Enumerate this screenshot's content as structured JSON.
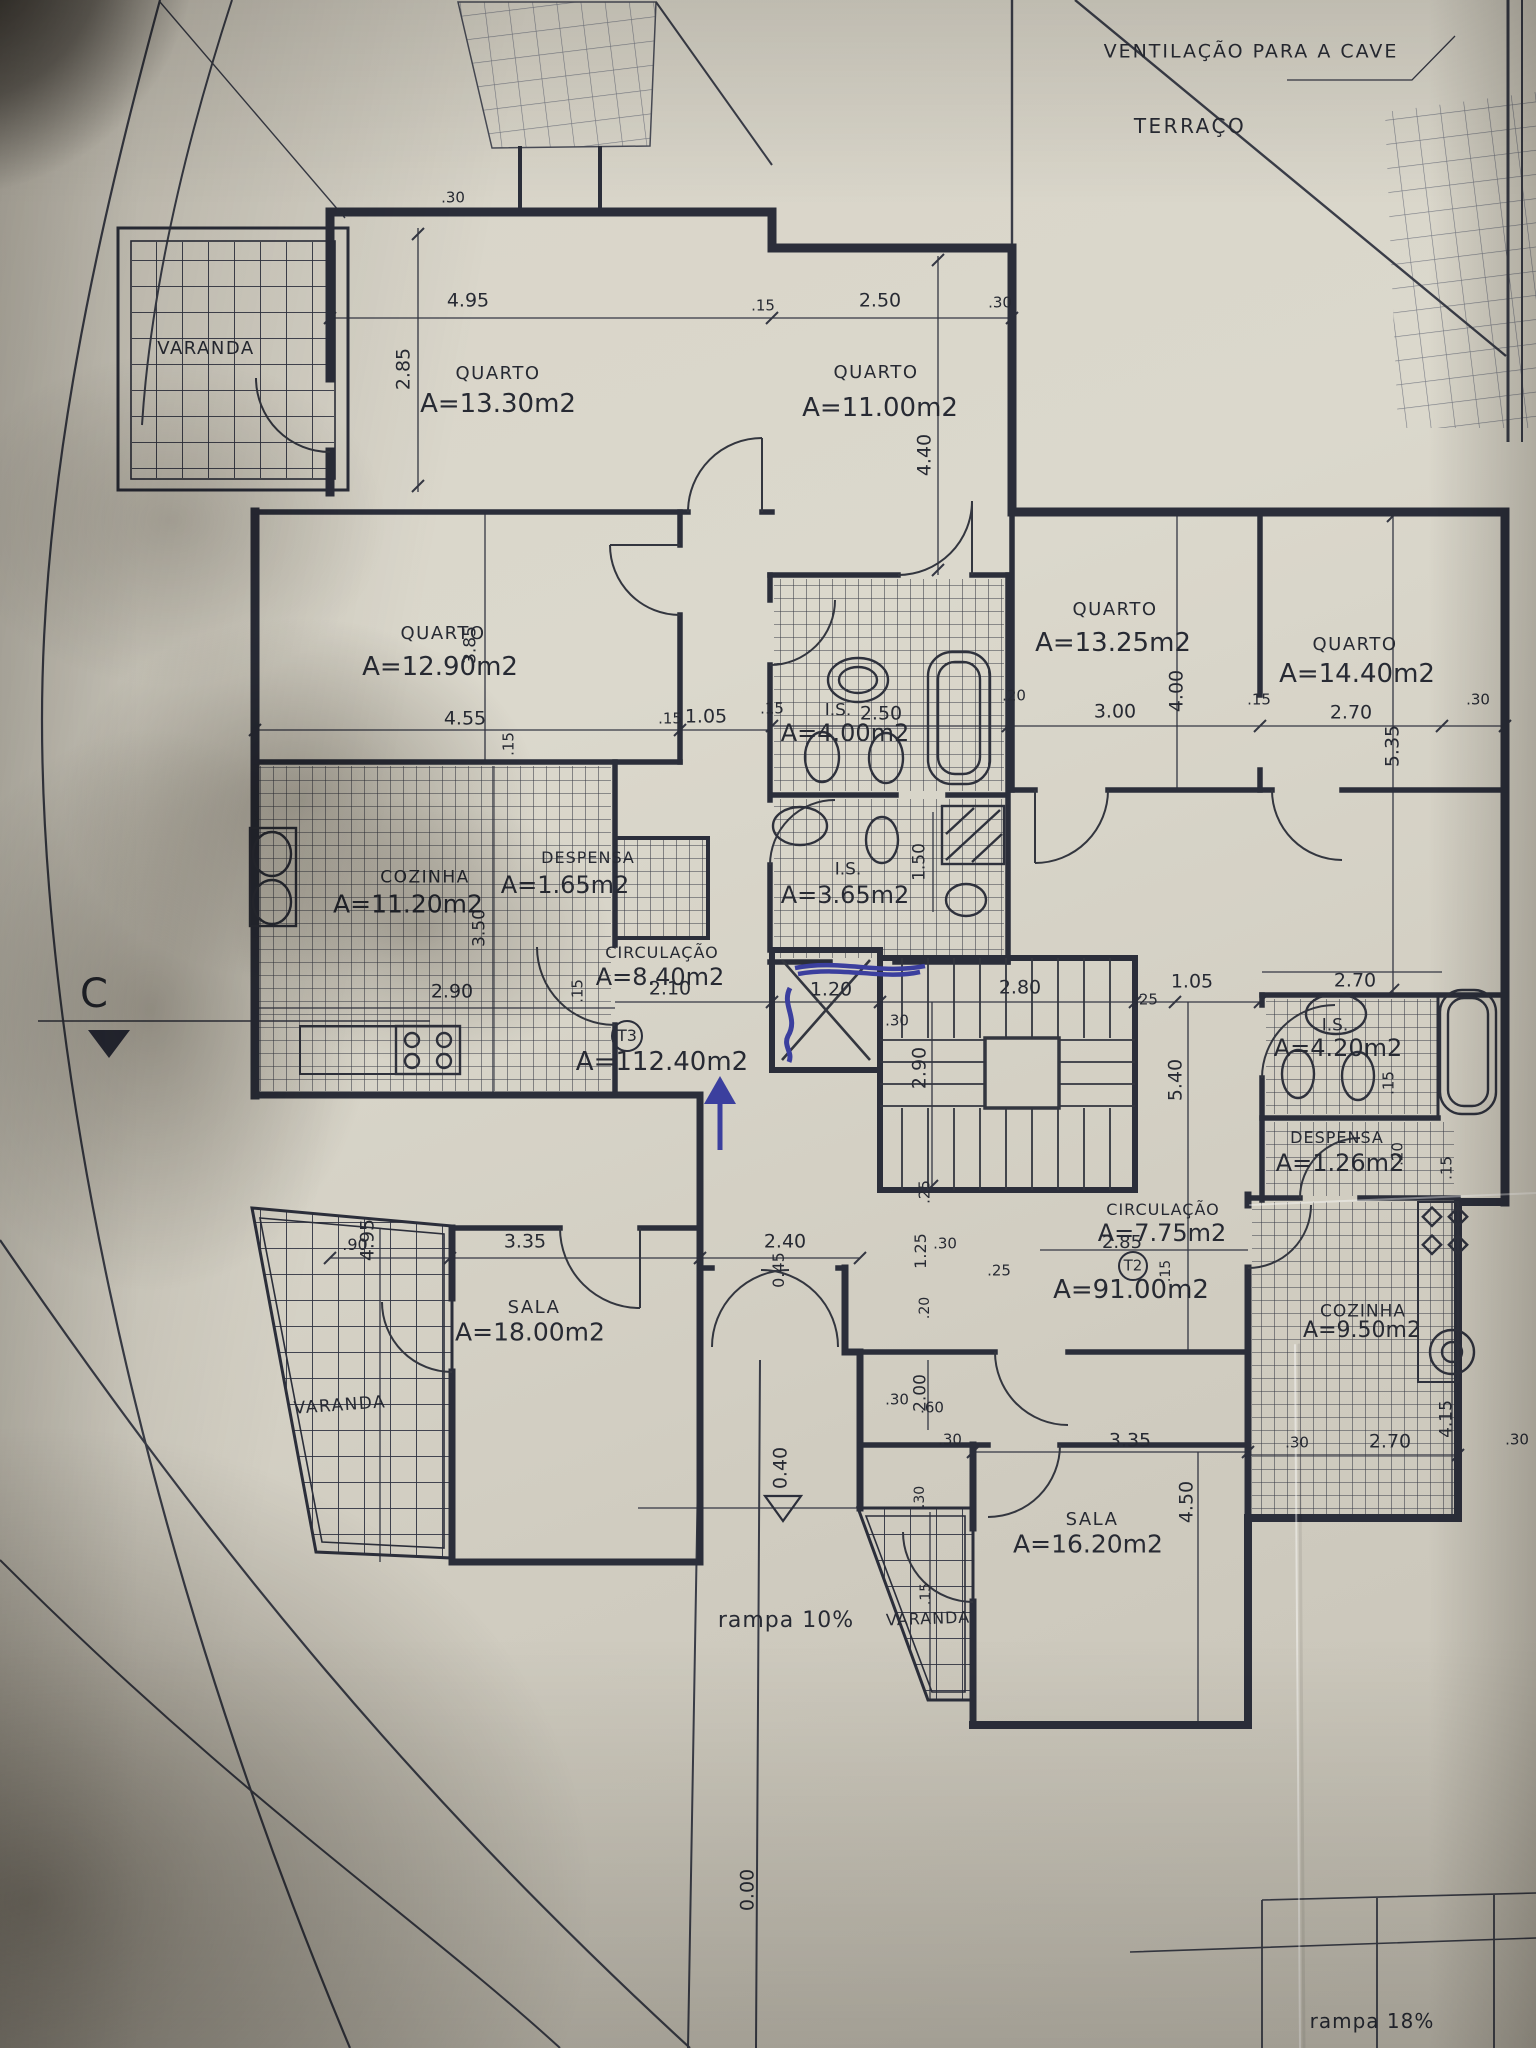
{
  "photo": {
    "paper_color": "#d4d0c4",
    "ink_color": "#2b2e3a",
    "pen_color": "#3b3f9e",
    "pen_annotations": [
      "up-arrow",
      "scribble-at-elevator",
      "scribble-horizontal"
    ]
  },
  "summary": {
    "notes": [
      "VENTILAÇÃO PARA A CAVE",
      "TERRAÇO",
      "rampa 10%",
      "rampa 18%"
    ],
    "section_marker": "C",
    "levels": [
      "0.40",
      "0.00"
    ],
    "apartments": [
      {
        "id": "T3",
        "total_area": "A=112.40m2",
        "rooms": [
          {
            "name": "QUARTO",
            "area": "A=13.30m2"
          },
          {
            "name": "QUARTO",
            "area": "A=11.00m2"
          },
          {
            "name": "QUARTO",
            "area": "A=12.90m2"
          },
          {
            "name": "I.S.",
            "area": "A=4.00m2"
          },
          {
            "name": "I.S.",
            "area": "A=3.65m2"
          },
          {
            "name": "COZINHA",
            "area": "A=11.20m2"
          },
          {
            "name": "DESPENSA",
            "area": "A=1.65m2"
          },
          {
            "name": "CIRCULAÇÃO",
            "area": "A=8.40m2"
          },
          {
            "name": "SALA",
            "area": "A=18.00m2"
          },
          {
            "name": "VARANDA",
            "area": ""
          },
          {
            "name": "VARANDA",
            "area": ""
          }
        ]
      },
      {
        "id": "T2",
        "total_area": "A=91.00m2",
        "rooms": [
          {
            "name": "QUARTO",
            "area": "A=13.25m2"
          },
          {
            "name": "QUARTO",
            "area": "A=14.40m2"
          },
          {
            "name": "I.S.",
            "area": "A=4.20m2"
          },
          {
            "name": "DESPENSA",
            "area": "A=1.26m2"
          },
          {
            "name": "CIRCULAÇÃO",
            "area": "A=7.75m2"
          },
          {
            "name": "COZINHA",
            "area": "A=9.50m2"
          },
          {
            "name": "SALA",
            "area": "A=16.20m2"
          },
          {
            "name": "VARANDA",
            "area": ""
          }
        ]
      }
    ]
  },
  "labels": [
    {
      "id": "ventilation-note",
      "text": "VENTILAÇÃO PARA A CAVE",
      "x": 1251,
      "y": 52,
      "fs": 19,
      "ls": 2
    },
    {
      "id": "terrace-label",
      "text": "TERRAÇO",
      "x": 1190,
      "y": 126,
      "fs": 20,
      "ls": 2.5
    },
    {
      "id": "section-c",
      "text": "C",
      "x": 94,
      "y": 994,
      "fs": 40
    },
    {
      "id": "varanda-top-left",
      "text": "VARANDA",
      "x": 206,
      "y": 349,
      "fs": 18,
      "ls": 1.5
    },
    {
      "id": "quarto1-name",
      "text": "QUARTO",
      "x": 498,
      "y": 374,
      "fs": 18,
      "ls": 1.5
    },
    {
      "id": "quarto1-area",
      "text": "A=13.30m2",
      "x": 498,
      "y": 404,
      "fs": 26
    },
    {
      "id": "quarto2-name",
      "text": "QUARTO",
      "x": 876,
      "y": 373,
      "fs": 18,
      "ls": 1.5
    },
    {
      "id": "quarto2-area",
      "text": "A=11.00m2",
      "x": 880,
      "y": 408,
      "fs": 26
    },
    {
      "id": "quarto3-name",
      "text": "QUARTO",
      "x": 443,
      "y": 634,
      "fs": 18,
      "ls": 1.5
    },
    {
      "id": "quarto3-area",
      "text": "A=12.90m2",
      "x": 440,
      "y": 667,
      "fs": 26
    },
    {
      "id": "is1-name",
      "text": "I.S.",
      "x": 838,
      "y": 711,
      "fs": 17
    },
    {
      "id": "is1-area",
      "text": "A=4.00m2",
      "x": 845,
      "y": 733,
      "fs": 24
    },
    {
      "id": "is2-name",
      "text": "I.S.",
      "x": 848,
      "y": 870,
      "fs": 17
    },
    {
      "id": "is2-area",
      "text": "A=3.65m2",
      "x": 845,
      "y": 895,
      "fs": 24
    },
    {
      "id": "cozinha1-name",
      "text": "COZINHA",
      "x": 425,
      "y": 878,
      "fs": 17,
      "ls": 1.5
    },
    {
      "id": "cozinha1-area",
      "text": "A=11.20m2",
      "x": 408,
      "y": 904,
      "fs": 25
    },
    {
      "id": "despensa1-name",
      "text": "DESPENSA",
      "x": 588,
      "y": 858,
      "fs": 16,
      "ls": 1
    },
    {
      "id": "despensa1-area",
      "text": "A=1.65m2",
      "x": 565,
      "y": 885,
      "fs": 24
    },
    {
      "id": "circulacao1-name",
      "text": "CIRCULAÇÃO",
      "x": 662,
      "y": 953,
      "fs": 16,
      "ls": 1
    },
    {
      "id": "circulacao1-area",
      "text": "A=8.40m2",
      "x": 660,
      "y": 977,
      "fs": 24
    },
    {
      "id": "t3-id",
      "text": "T3",
      "x": 627,
      "y": 1036,
      "fs": 16
    },
    {
      "id": "t3-area",
      "text": "A=112.40m2",
      "x": 662,
      "y": 1062,
      "fs": 26
    },
    {
      "id": "sala1-name",
      "text": "SALA",
      "x": 534,
      "y": 1308,
      "fs": 18,
      "ls": 1.5
    },
    {
      "id": "sala1-area",
      "text": "A=18.00m2",
      "x": 530,
      "y": 1332,
      "fs": 25
    },
    {
      "id": "varanda-left",
      "text": "VARANDA",
      "x": 340,
      "y": 1406,
      "fs": 17,
      "ls": 1.5,
      "rot": -4
    },
    {
      "id": "varanda-bottom",
      "text": "VARANDA",
      "x": 928,
      "y": 1619,
      "fs": 16,
      "ls": 1,
      "rot": -2
    },
    {
      "id": "quarto4-name",
      "text": "QUARTO",
      "x": 1115,
      "y": 610,
      "fs": 18,
      "ls": 1.5
    },
    {
      "id": "quarto4-area",
      "text": "A=13.25m2",
      "x": 1113,
      "y": 643,
      "fs": 26
    },
    {
      "id": "quarto5-name",
      "text": "QUARTO",
      "x": 1355,
      "y": 645,
      "fs": 18,
      "ls": 1.5
    },
    {
      "id": "quarto5-area",
      "text": "A=14.40m2",
      "x": 1357,
      "y": 674,
      "fs": 26
    },
    {
      "id": "is3-name",
      "text": "I.S.",
      "x": 1335,
      "y": 1026,
      "fs": 17
    },
    {
      "id": "is3-area",
      "text": "A=4.20m2",
      "x": 1338,
      "y": 1048,
      "fs": 24
    },
    {
      "id": "despensa2-name",
      "text": "DESPENSA",
      "x": 1337,
      "y": 1138,
      "fs": 16,
      "ls": 1
    },
    {
      "id": "despensa2-area",
      "text": "A=1.26m2",
      "x": 1340,
      "y": 1163,
      "fs": 24
    },
    {
      "id": "circulacao2-name",
      "text": "CIRCULAÇÃO",
      "x": 1163,
      "y": 1210,
      "fs": 16,
      "ls": 1
    },
    {
      "id": "circulacao2-area",
      "text": "A=7.75m2",
      "x": 1162,
      "y": 1233,
      "fs": 24
    },
    {
      "id": "t2-id",
      "text": "T2",
      "x": 1133,
      "y": 1266,
      "fs": 15
    },
    {
      "id": "t2-area",
      "text": "A=91.00m2",
      "x": 1131,
      "y": 1290,
      "fs": 26
    },
    {
      "id": "cozinha2-name",
      "text": "COZINHA",
      "x": 1363,
      "y": 1312,
      "fs": 17,
      "ls": 1
    },
    {
      "id": "cozinha2-area",
      "text": "A=9.50m2",
      "x": 1362,
      "y": 1331,
      "fs": 22
    },
    {
      "id": "sala2-name",
      "text": "SALA",
      "x": 1092,
      "y": 1520,
      "fs": 18,
      "ls": 1.5
    },
    {
      "id": "sala2-area",
      "text": "A=16.20m2",
      "x": 1088,
      "y": 1544,
      "fs": 25
    },
    {
      "id": "dim-495-top",
      "text": "4.95",
      "x": 468,
      "y": 301,
      "fs": 19
    },
    {
      "id": "dim-250-top",
      "text": "2.50",
      "x": 880,
      "y": 301,
      "fs": 19
    },
    {
      "id": "dim-30-top-right",
      "text": ".30",
      "x": 1000,
      "y": 303,
      "fs": 15
    },
    {
      "id": "dim-285-v",
      "text": "2.85",
      "x": 404,
      "y": 369,
      "fs": 19,
      "rot": -90
    },
    {
      "id": "dim-440-v",
      "text": "4.40",
      "x": 925,
      "y": 455,
      "fs": 19,
      "rot": -90
    },
    {
      "id": "dim-30-top-left",
      "text": ".30",
      "x": 453,
      "y": 198,
      "fs": 15
    },
    {
      "id": "dim-15-top-mid",
      "text": ".15",
      "x": 763,
      "y": 306,
      "fs": 15
    },
    {
      "id": "dim-455",
      "text": "4.55",
      "x": 465,
      "y": 719,
      "fs": 19
    },
    {
      "id": "dim-15-q3",
      "text": ".15",
      "x": 509,
      "y": 744,
      "fs": 15,
      "rot": -90
    },
    {
      "id": "dim-385-v",
      "text": "3.85",
      "x": 471,
      "y": 645,
      "fs": 17,
      "rot": -90
    },
    {
      "id": "dim-105-left",
      "text": "1.05",
      "x": 706,
      "y": 717,
      "fs": 19
    },
    {
      "id": "dim-15-mid",
      "text": ".15",
      "x": 670,
      "y": 719,
      "fs": 15
    },
    {
      "id": "dim-250-is",
      "text": "2.50",
      "x": 881,
      "y": 714,
      "fs": 19
    },
    {
      "id": "dim-15-is",
      "text": ".15",
      "x": 772,
      "y": 709,
      "fs": 15
    },
    {
      "id": "dim-20-shaft",
      "text": ".20",
      "x": 1014,
      "y": 696,
      "fs": 15
    },
    {
      "id": "dim-300",
      "text": "3.00",
      "x": 1115,
      "y": 712,
      "fs": 19
    },
    {
      "id": "dim-400-v",
      "text": "4.00",
      "x": 1177,
      "y": 691,
      "fs": 19,
      "rot": -90
    },
    {
      "id": "dim-270-q5",
      "text": "2.70",
      "x": 1351,
      "y": 713,
      "fs": 19
    },
    {
      "id": "dim-535-v",
      "text": "5.35",
      "x": 1393,
      "y": 746,
      "fs": 19,
      "rot": -90
    },
    {
      "id": "dim-15-q5",
      "text": ".15",
      "x": 1259,
      "y": 700,
      "fs": 15
    },
    {
      "id": "dim-30-q5",
      "text": ".30",
      "x": 1478,
      "y": 700,
      "fs": 15
    },
    {
      "id": "dim-150-v",
      "text": "1.50",
      "x": 920,
      "y": 862,
      "fs": 17,
      "rot": -90
    },
    {
      "id": "dim-350-v",
      "text": "3.50",
      "x": 480,
      "y": 928,
      "fs": 17,
      "rot": -90
    },
    {
      "id": "dim-290-coz",
      "text": "2.90",
      "x": 452,
      "y": 992,
      "fs": 19
    },
    {
      "id": "dim-15-coz",
      "text": ".15",
      "x": 578,
      "y": 991,
      "fs": 15,
      "rot": -90
    },
    {
      "id": "dim-210-circ",
      "text": "2.10",
      "x": 670,
      "y": 989,
      "fs": 19
    },
    {
      "id": "dim-120-elev",
      "text": "1.20",
      "x": 831,
      "y": 990,
      "fs": 19
    },
    {
      "id": "dim-280-stair",
      "text": "2.80",
      "x": 1020,
      "y": 988,
      "fs": 19
    },
    {
      "id": "dim-25-stair",
      "text": ".25",
      "x": 1146,
      "y": 1000,
      "fs": 15
    },
    {
      "id": "dim-105-right",
      "text": "1.05",
      "x": 1192,
      "y": 982,
      "fs": 19
    },
    {
      "id": "dim-30-stair",
      "text": ".30",
      "x": 897,
      "y": 1021,
      "fs": 15
    },
    {
      "id": "dim-290-stair-v",
      "text": "2.90",
      "x": 920,
      "y": 1068,
      "fs": 19,
      "rot": -90
    },
    {
      "id": "dim-540-v",
      "text": "5.40",
      "x": 1176,
      "y": 1080,
      "fs": 19,
      "rot": -90
    },
    {
      "id": "dim-25-stair-v",
      "text": ".25",
      "x": 925,
      "y": 1192,
      "fs": 15,
      "rot": -90
    },
    {
      "id": "dim-270-is3",
      "text": "2.70",
      "x": 1355,
      "y": 981,
      "fs": 19
    },
    {
      "id": "dim-15-is3",
      "text": ".15",
      "x": 1389,
      "y": 1083,
      "fs": 15,
      "rot": -90
    },
    {
      "id": "dim-20-desp2",
      "text": ".20",
      "x": 1398,
      "y": 1154,
      "fs": 15,
      "rot": -90
    },
    {
      "id": "dim-15-desp2",
      "text": ".15",
      "x": 1447,
      "y": 1168,
      "fs": 15,
      "rot": -90
    },
    {
      "id": "dim-285-t2",
      "text": "2.85",
      "x": 1122,
      "y": 1243,
      "fs": 18
    },
    {
      "id": "dim-15-t2",
      "text": ".15",
      "x": 1166,
      "y": 1271,
      "fs": 14,
      "rot": -90
    },
    {
      "id": "dim-90",
      "text": ".90",
      "x": 355,
      "y": 1245,
      "fs": 16
    },
    {
      "id": "dim-335-sala1",
      "text": "3.35",
      "x": 525,
      "y": 1242,
      "fs": 19
    },
    {
      "id": "dim-495-sala1-v",
      "text": "4.95",
      "x": 368,
      "y": 1240,
      "fs": 19,
      "rot": -90
    },
    {
      "id": "dim-240-entry",
      "text": "2.40",
      "x": 785,
      "y": 1242,
      "fs": 19
    },
    {
      "id": "dim-045-v",
      "text": "0.45",
      "x": 779,
      "y": 1270,
      "fs": 16,
      "rot": -90
    },
    {
      "id": "dim-125-v",
      "text": "1.25",
      "x": 921,
      "y": 1251,
      "fs": 16,
      "rot": -90
    },
    {
      "id": "dim-30-entry",
      "text": ".30",
      "x": 945,
      "y": 1244,
      "fs": 15
    },
    {
      "id": "dim-25-entry",
      "text": ".25",
      "x": 999,
      "y": 1271,
      "fs": 15
    },
    {
      "id": "dim-20-entry",
      "text": ".20",
      "x": 925,
      "y": 1308,
      "fs": 14,
      "rot": -90
    },
    {
      "id": "dim-200-v",
      "text": "2.00",
      "x": 921,
      "y": 1393,
      "fs": 17,
      "rot": -90
    },
    {
      "id": "dim-30-vest",
      "text": ".30",
      "x": 897,
      "y": 1400,
      "fs": 15
    },
    {
      "id": "dim-60-vest",
      "text": ".60",
      "x": 932,
      "y": 1408,
      "fs": 15
    },
    {
      "id": "dim-335-sala2",
      "text": "3.35",
      "x": 1130,
      "y": 1441,
      "fs": 19
    },
    {
      "id": "dim-30-sala2",
      "text": ".30",
      "x": 950,
      "y": 1440,
      "fs": 15
    },
    {
      "id": "dim-450-v",
      "text": "4.50",
      "x": 1187,
      "y": 1502,
      "fs": 19,
      "rot": -90
    },
    {
      "id": "dim-270-coz2",
      "text": "2.70",
      "x": 1390,
      "y": 1442,
      "fs": 19
    },
    {
      "id": "dim-30-coz2-l",
      "text": ".30",
      "x": 1297,
      "y": 1443,
      "fs": 15
    },
    {
      "id": "dim-30-coz2-r",
      "text": ".30",
      "x": 1517,
      "y": 1440,
      "fs": 15
    },
    {
      "id": "dim-415-v",
      "text": "4.15",
      "x": 1447,
      "y": 1419,
      "fs": 17,
      "rot": -90
    },
    {
      "id": "dim-30-var-v",
      "text": ".30",
      "x": 920,
      "y": 1497,
      "fs": 14,
      "rot": -90
    },
    {
      "id": "dim-15-var-v",
      "text": ".15",
      "x": 926,
      "y": 1594,
      "fs": 14,
      "rot": -90
    },
    {
      "id": "level-040",
      "text": "0.40",
      "x": 781,
      "y": 1468,
      "fs": 19,
      "rot": -90
    },
    {
      "id": "ramp-left",
      "text": "rampa  10%",
      "x": 786,
      "y": 1621,
      "fs": 22,
      "ls": 1
    },
    {
      "id": "level-000",
      "text": "0.00",
      "x": 748,
      "y": 1890,
      "fs": 19,
      "rot": -90
    },
    {
      "id": "ramp-right",
      "text": "rampa  18%",
      "x": 1372,
      "y": 2021,
      "fs": 20,
      "ls": 1
    }
  ]
}
